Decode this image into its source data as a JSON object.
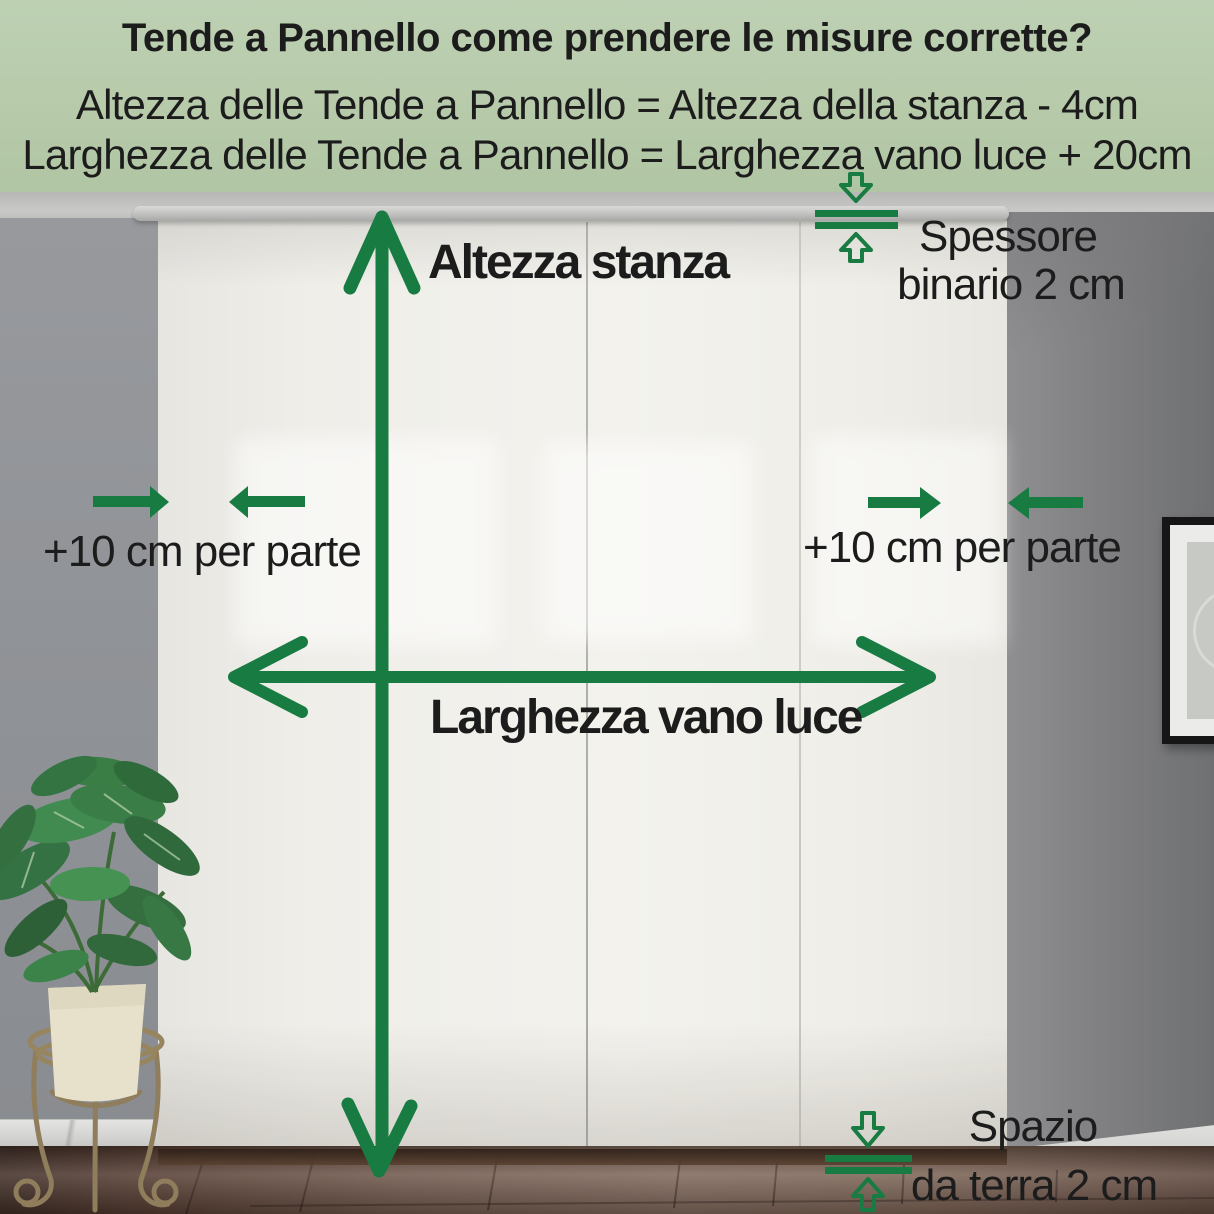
{
  "header": {
    "title": "Tende a Pannello come prendere le misure corrette?",
    "height_formula": "Altezza delle Tende a Pannello = Altezza della stanza - 4cm",
    "width_formula": "Larghezza delle Tende a Pannello = Larghezza vano luce + 20cm"
  },
  "measurements": {
    "room_height_label": "Altezza stanza",
    "opening_width_label": "Larghezza vano luce",
    "left_side_allowance": "+10 cm per parte",
    "right_side_allowance": "+10 cm per parte",
    "rail_thickness": {
      "line1": "Spessore",
      "line2": "binario 2 cm"
    },
    "floor_clearance": {
      "line1": "Spazio",
      "line2": "da terra 2 cm"
    }
  },
  "colors": {
    "accent_green": "#187B41",
    "header_background": "#B7CBAB",
    "text": "#1C1C1C"
  }
}
